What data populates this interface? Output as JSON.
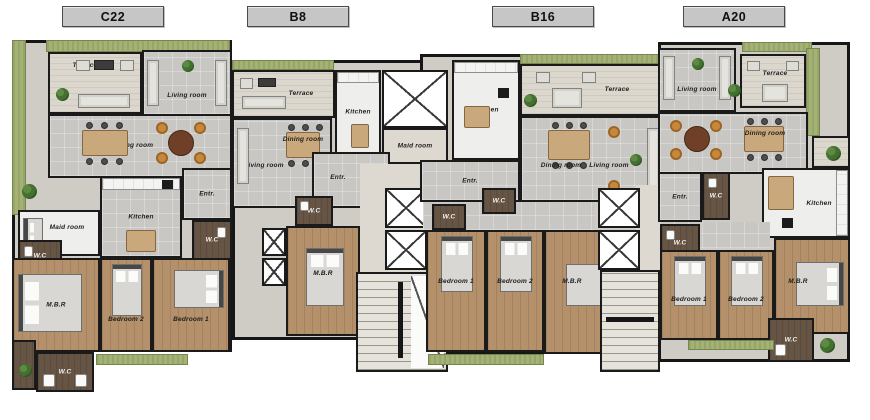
{
  "plan_title": "Apartment floor plan",
  "units": [
    {
      "id": "C22",
      "rooms": {
        "terrace": "Terrace",
        "living": "Living room",
        "dining": "Dining room",
        "kitchen": "Kitchen",
        "maid": "Maid room",
        "entr": "Entr.",
        "wc_maid": "W.C",
        "wc_entr": "W.C",
        "wc_bottom": "W.C",
        "mbr": "M.B.R",
        "bedroom2": "Bedroom 2",
        "bedroom1": "Bedroom 1"
      }
    },
    {
      "id": "B8",
      "rooms": {
        "terrace": "Terrace",
        "living": "Living room",
        "dining": "Dining room",
        "kitchen": "Kitchen",
        "maid": "Maid room",
        "entr": "Entr.",
        "wc": "W.C",
        "mbr": "M.B.R"
      }
    },
    {
      "id": "B16",
      "rooms": {
        "terrace": "Terrace",
        "living": "Living room",
        "dining": "Dining room",
        "kitchen": "Kitchen",
        "entr": "Entr.",
        "wc_hall1": "W.C",
        "wc_hall2": "W.C",
        "bedroom1": "Bedroom 1",
        "bedroom2": "Bedroom 2",
        "mbr": "M.B.R"
      }
    },
    {
      "id": "A20",
      "rooms": {
        "terrace": "Terrace",
        "living": "Living room",
        "dining": "Dining room",
        "kitchen": "Kitchen",
        "entr": "Entr.",
        "wc_entr": "W.C",
        "wc_hall": "W.C",
        "wc_mbr": "W.C",
        "bedroom1": "Bedroom 1",
        "bedroom2": "Bedroom 2",
        "mbr": "M.B.R"
      }
    }
  ],
  "colors": {
    "wall": "#1a1a1a",
    "tile_floor": "#c8c7c3",
    "wood_floor": "#b4916b",
    "terrace_floor": "#dbd7cd",
    "landscape_green": "#a4b274",
    "wc_floor": "#665544",
    "core_floor": "#ddd9d0",
    "counter": "#f3f3f1",
    "chair_accent": "#c8883c",
    "tag_background": "#c6c6c6"
  }
}
